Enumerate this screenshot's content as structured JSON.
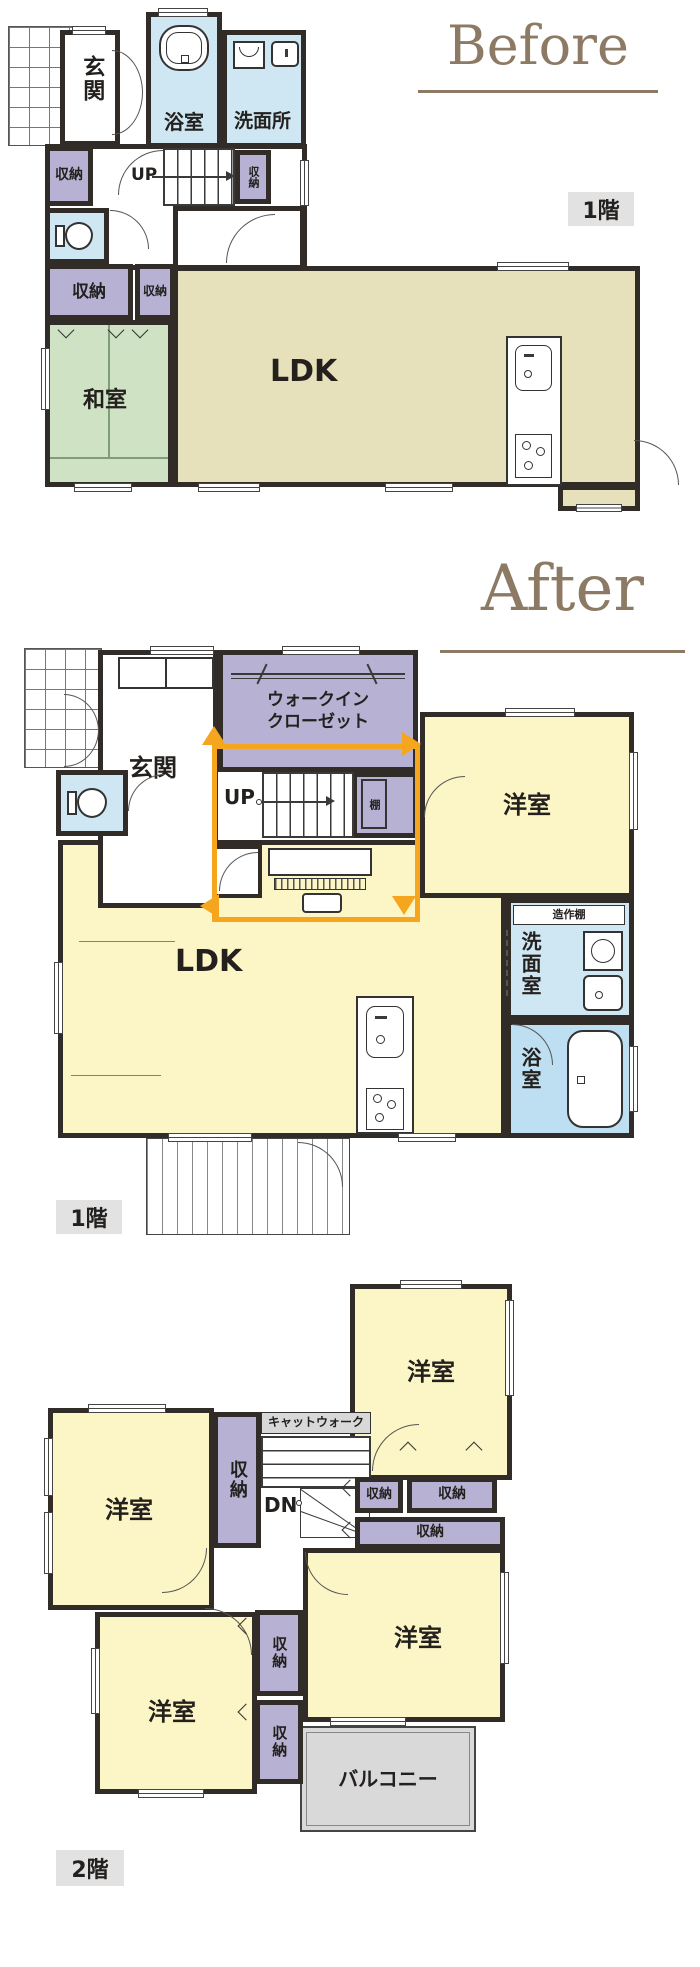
{
  "colors": {
    "wall": "#322c28",
    "room_yellow": "#fcf5c5",
    "room_beige": "#e7e1bb",
    "room_green": "#cfe3c4",
    "closet_purple": "#b7b2d4",
    "wet_blue": "#cfe6f3",
    "bath_blue": "#bddff1",
    "balcony_gray": "#d9d9d9",
    "catwalk_gray": "#d8d8d8",
    "furniture_tan": "#cbbd9d",
    "flow_arrow_orange": "#f6a61e",
    "title_brown": "#8c7a64",
    "floor_label_bg": "#e2e2e2"
  },
  "icons": {
    "porch-tile-icon": "grid tiles",
    "bathtub-icon": "rounded rectangle outline tub",
    "toilet-icon": "tank and bowl outline",
    "washbasin-icon": "rounded square with faucet dot",
    "washing-machine-icon": "square with drum arc",
    "kitchen-sink-icon": "rounded rect with faucet dot",
    "stove-icon": "rect with burner circles",
    "stairs-up-arrow-icon": "line with arrowhead",
    "hanger-rod-icon": "rod with slash marks",
    "flow-loop-arrows-icon": "orange loop with four arrowheads",
    "deck-hatch-icon": "vertical hatch boards"
  },
  "before": {
    "title": "Before",
    "floor_label": "1階",
    "rooms": {
      "genkan": "玄関",
      "bath": "浴室",
      "washroom": "洗面所",
      "closet_hall": "収納",
      "closet_stairs": "収納",
      "closet_west": "収納",
      "closet_small": "収納",
      "stairs": "UP",
      "washitsu": "和室",
      "ldk": "LDK"
    }
  },
  "after": {
    "title": "After",
    "floor_label": "1階",
    "rooms": {
      "genkan": "玄関",
      "wic_line1": "ウォークイン",
      "wic_line2": "クローゼット",
      "stairs": "UP",
      "shelf": "棚",
      "youshitsu": "洋室",
      "builtin_shelf": "造作棚",
      "senmen": "洗面室",
      "bath": "浴室",
      "ldk": "LDK"
    }
  },
  "floor2": {
    "floor_label": "2階",
    "rooms": {
      "youshitsu_ne": "洋室",
      "youshitsu_w": "洋室",
      "youshitsu_se": "洋室",
      "youshitsu_sw": "洋室",
      "catwalk": "キャットウォーク",
      "stairs": "DN",
      "closet_center": "収納",
      "closet_r1": "収納",
      "closet_r2": "収納",
      "closet_r_wide": "収納",
      "closet_m1": "収納",
      "closet_m2": "収納",
      "balcony": "バルコニー"
    }
  }
}
